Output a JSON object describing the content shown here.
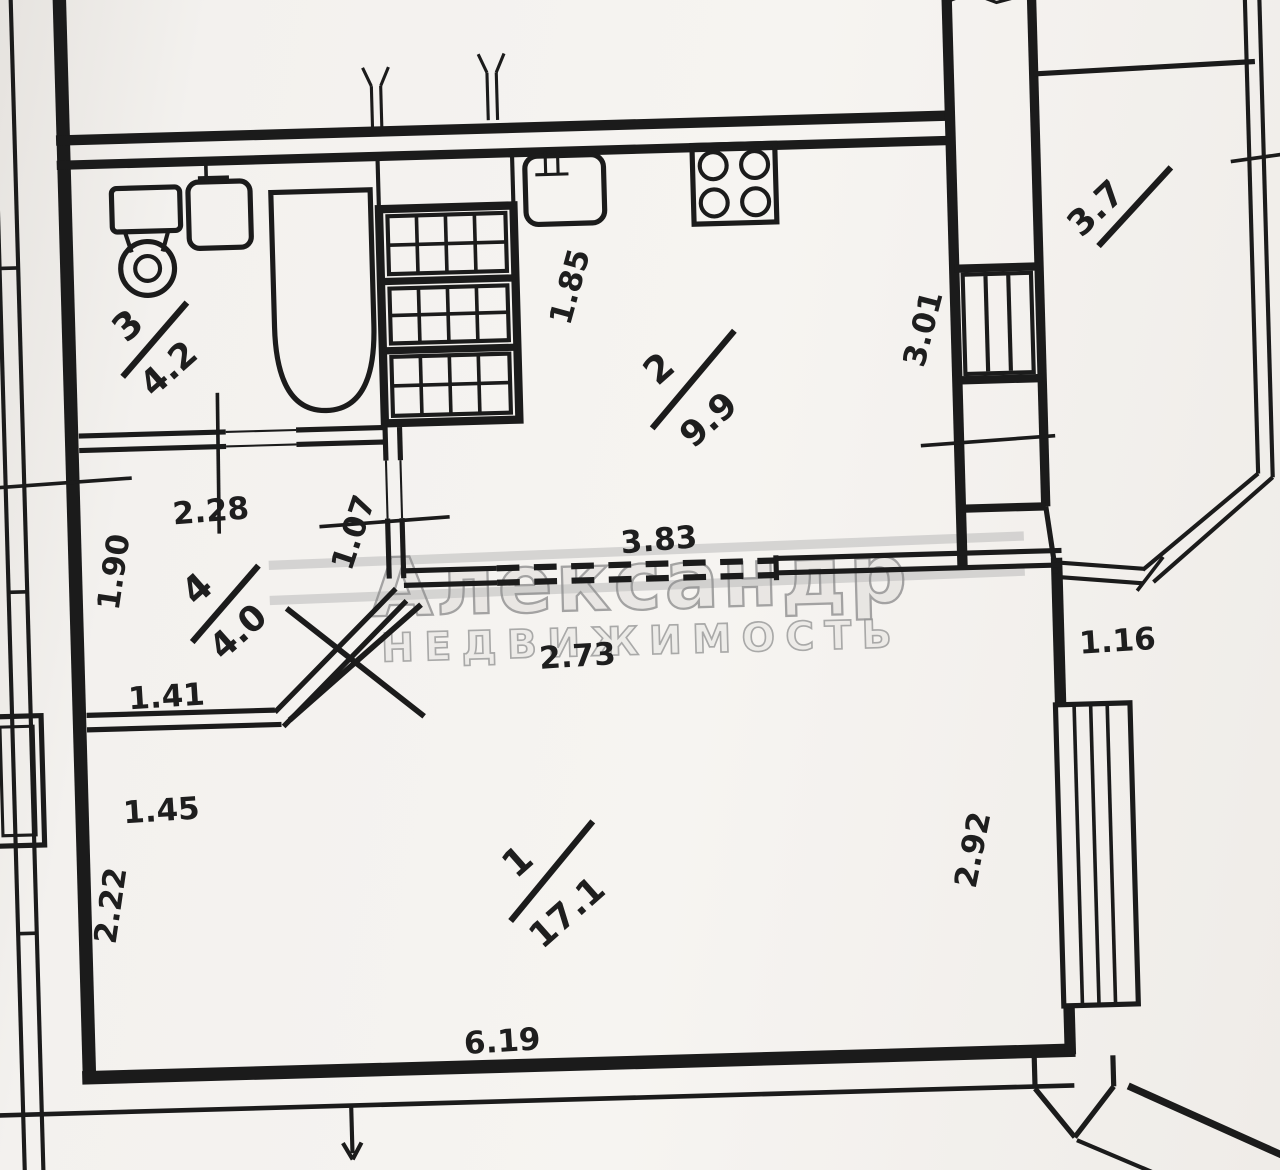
{
  "watermark": {
    "line1": "Александр",
    "line2": "НЕДВИЖИМОСТЬ"
  },
  "rooms": [
    {
      "number": "1",
      "area": "17.1"
    },
    {
      "number": "2",
      "area": "9.9"
    },
    {
      "number": "3",
      "area": "4.2"
    },
    {
      "number": "4",
      "area": "4.0"
    },
    {
      "number": "",
      "area": "3.7"
    }
  ],
  "dimensions": {
    "bath_door": "2.28",
    "kitchen_door": "1.07",
    "hall_left": "1.90",
    "hall_bottom": "1.41",
    "room1_left_upper": "1.45",
    "room1_left": "2.22",
    "room1_bottom": "6.19",
    "room1_right": "2.92",
    "room1_top": "2.73",
    "partition_top": "3.83",
    "right_segment": "1.16",
    "kitchen_right": "3.01",
    "kitchen_top": "1.85"
  }
}
